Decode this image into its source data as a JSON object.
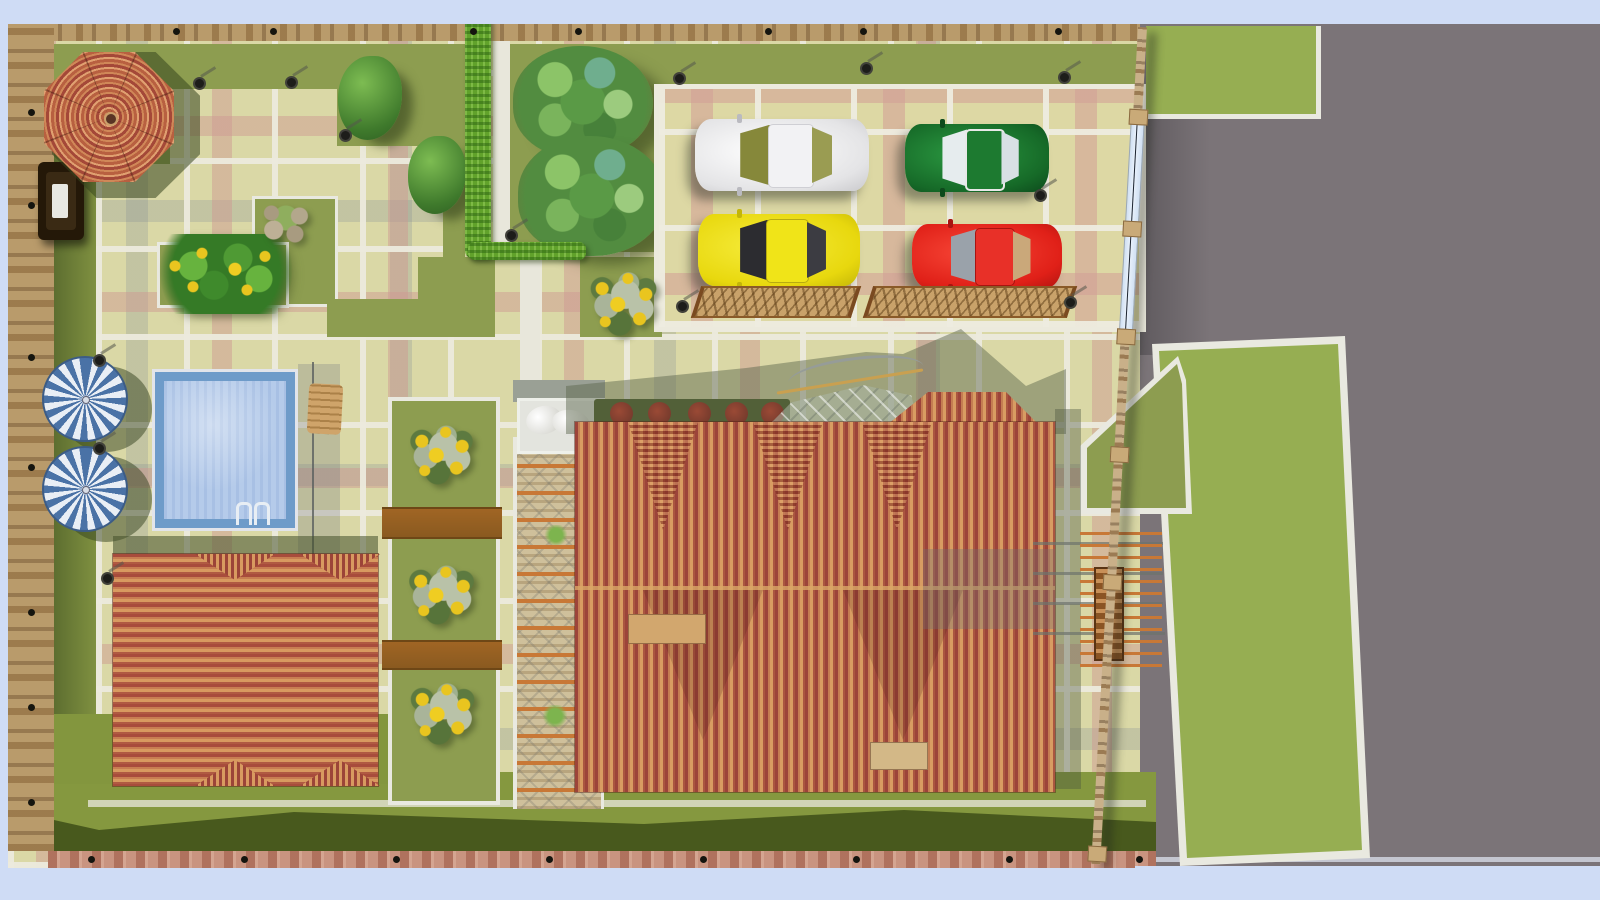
{
  "scene": {
    "description": "Top-down 3D architectural landscape render of a fenced residential lot with house, pool, gazebo, parking court and street",
    "labels": {
      "site": "walled garden lot",
      "road": "asphalt street",
      "house_roof": "house with striped terracotta hip roof",
      "deck_building": "outbuilding with striped hip roof",
      "gazebo": "octagonal gazebo with radial striped roof",
      "pool": "tiled swimming pool",
      "pool_ladder": "pool ladder",
      "umbrella": "blue and white parasol",
      "lounger": "wooden lounge chair",
      "parking": "paved parking court",
      "car_white": "white car",
      "car_green": "green car",
      "car_yellow": "yellow car",
      "car_red": "red car",
      "trellis": "low woven trellis screen",
      "gate": "glazed entrance gate",
      "fence": "stone boundary fence",
      "hedge": "clipped bright hedge",
      "tree": "tropical ornamental tree",
      "bush": "garden shrub",
      "sunflowers": "sunflower planting",
      "flower_bed": "flower bed with yellow blooms",
      "red_hedge": "hedge with red flowering shrubs",
      "rock_garden": "rockery with plant",
      "statue": "white garden statue",
      "canopy": "glazed entrance canopy with curved railing",
      "pergola_west": "beamed pergola walk",
      "pergola_east": "beamed pergola with ladder rack",
      "wall_niche": "wall fountain niche",
      "lamp": "garden lamp post",
      "lawn": "lawn",
      "bridge": "timber board bridge",
      "path": "white garden path"
    },
    "counts": {
      "cars": 4,
      "umbrellas": 2,
      "sunflower_clusters": 4,
      "red_shrubs": 5,
      "garden_lamps": 13
    }
  },
  "objects": {
    "cars": [
      {
        "name": "car_white",
        "hex": "#e9e9ea"
      },
      {
        "name": "car_green",
        "hex": "#166a28"
      },
      {
        "name": "car_yellow",
        "hex": "#e8d80e"
      },
      {
        "name": "car_red",
        "hex": "#e02018"
      }
    ]
  },
  "palette": {
    "sky": "#cfdcf5",
    "road": "#7b7478",
    "lawn": "#8d9d50",
    "lawnbright": "#96ae52",
    "lawndark": "#48591d",
    "paving": "#dad8a6",
    "wall": "#b99b6b",
    "pooltile": "#6e9bc9",
    "poolwater": "#b5cbea",
    "umbblue": "#4a72a6",
    "roofred": "#9c443a",
    "rooftan": "#d89c62",
    "hedgegreen": "#61a22b",
    "beam": "#c87836"
  }
}
